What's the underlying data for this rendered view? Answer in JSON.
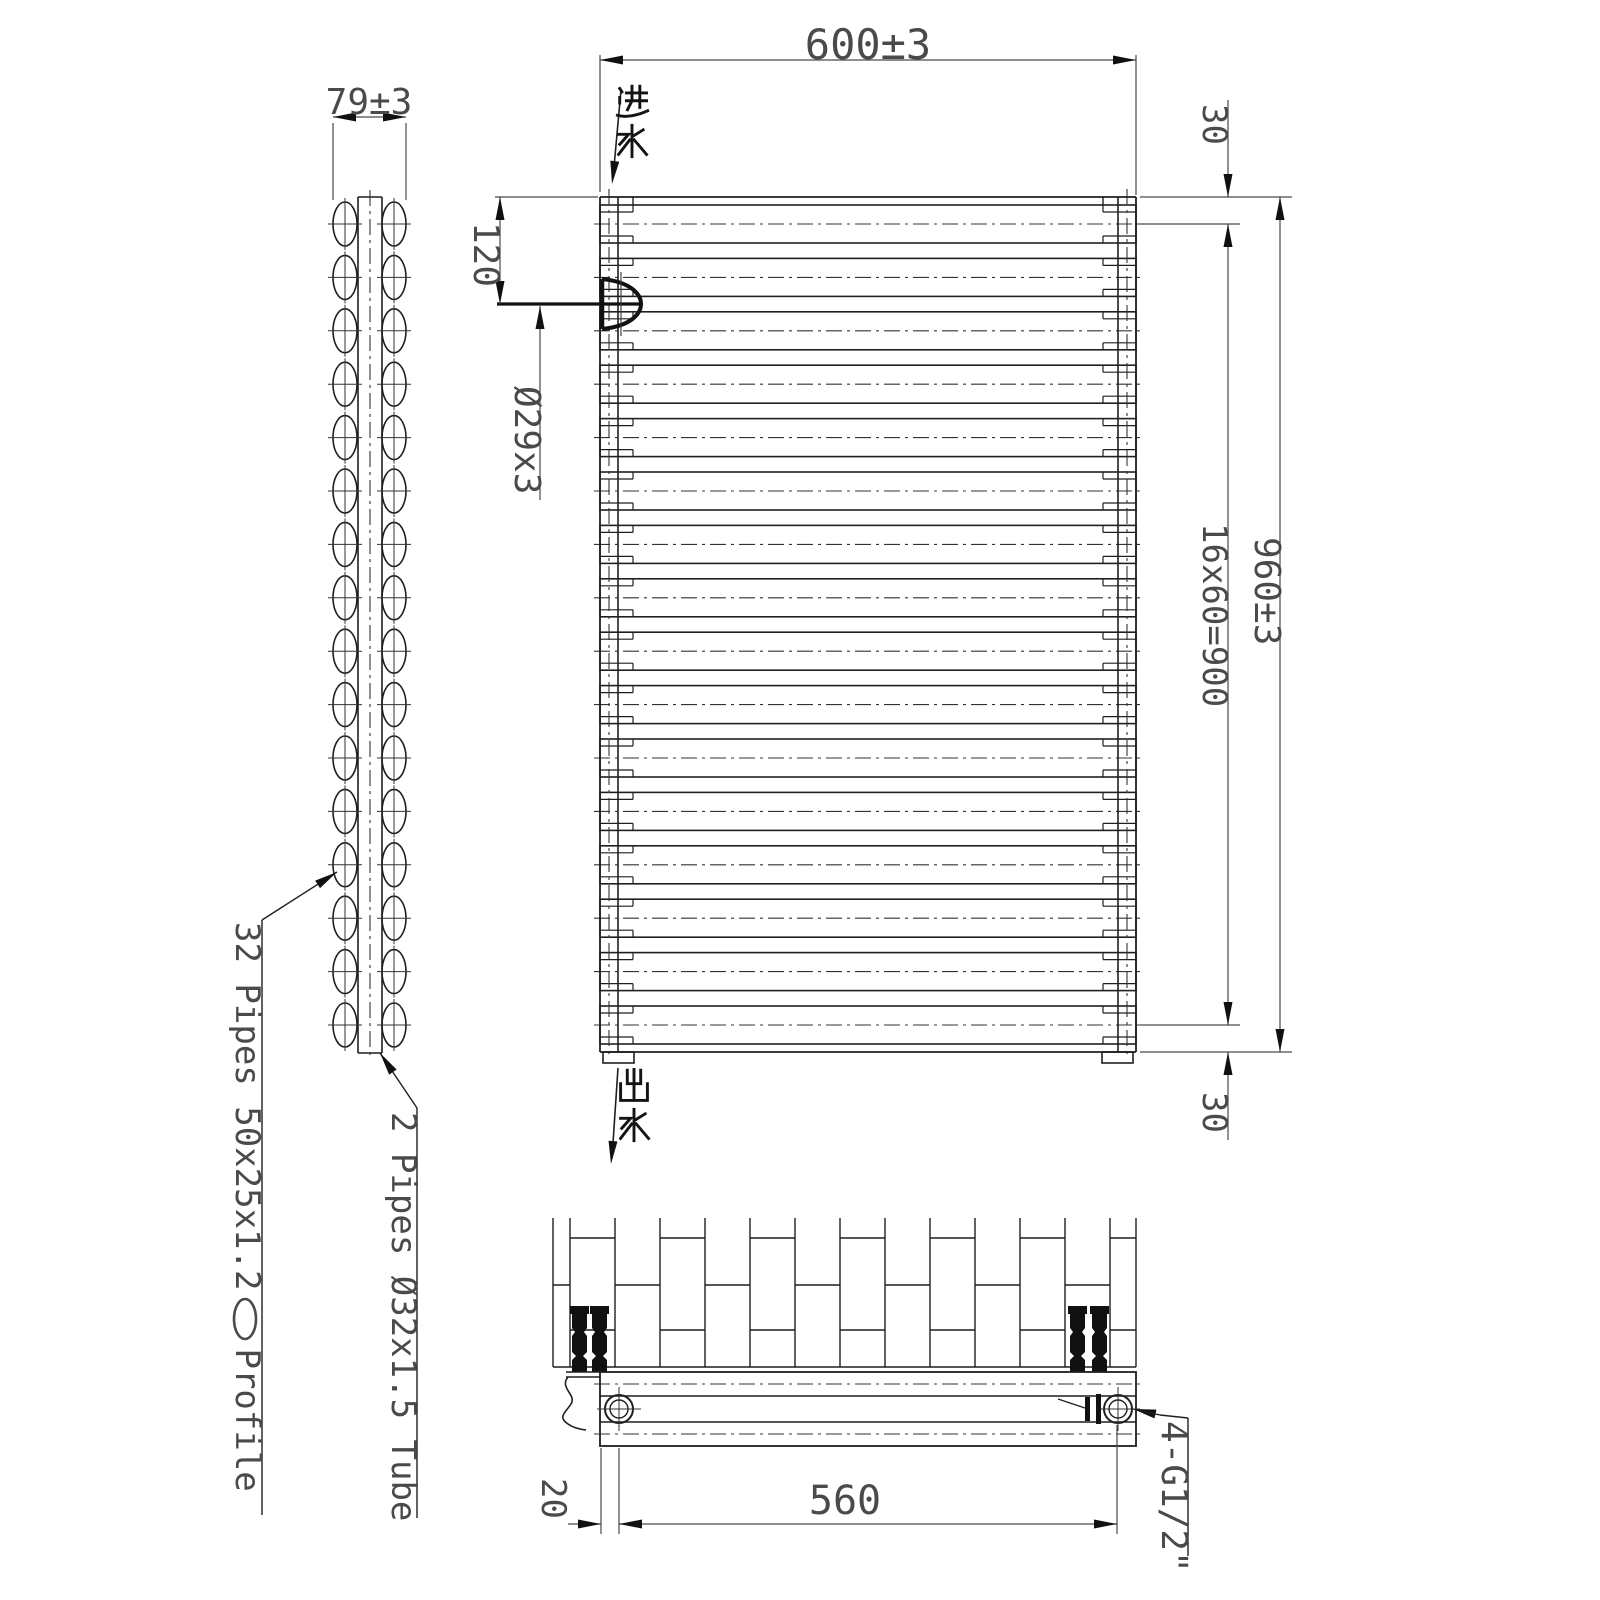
{
  "title": "Towel radiator technical drawing",
  "colors": {
    "line": "#1f1f1f",
    "dim": "#4a4a4a",
    "bold": "#111111",
    "bg": "#ffffff"
  },
  "views": {
    "side": {
      "width_dim": "79±3",
      "pipe_leader_1": "32 Pipes 50x25x1.2",
      "pipe_leader_1_suffix": "Profile",
      "pipe_leader_2": "2 Pipes Ø32x1.5 Tube",
      "tube_rows": 16,
      "tube_columns": 2
    },
    "front": {
      "width_dim": "600±3",
      "inlet": "进水",
      "outlet": "出水",
      "inlet_offset_dim": "120",
      "air_vent_dim": "Ø29x3",
      "top_margin_dim": "30",
      "tube_pitch_dim": "16x60=900",
      "height_dim": "960±3",
      "bottom_margin_dim": "30",
      "tube_count": 16
    },
    "plan": {
      "connection_dim": "4-G1/2\"",
      "connection_spacing_dim": "560",
      "end_offset_dim": "20"
    }
  }
}
